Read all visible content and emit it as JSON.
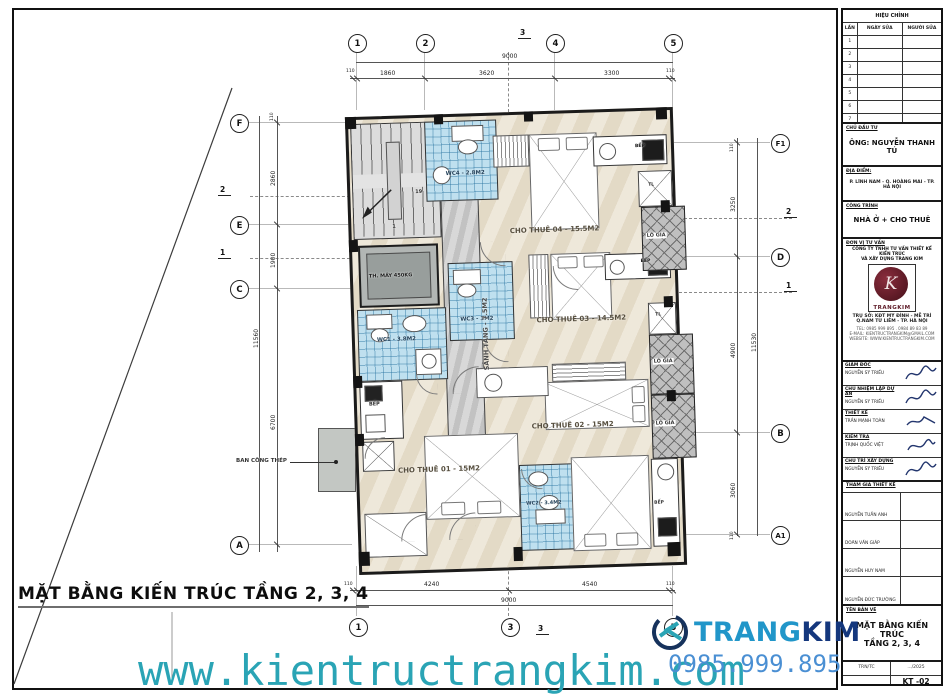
{
  "sheet_title": "MẶT BẰNG KIẾN TRÚC TẦNG 2, 3, 4",
  "footer": {
    "website": "www.kientructrangkim.com",
    "phone": "0985.999.895",
    "logo_trang": "TRANG",
    "logo_kim": "KIM"
  },
  "plan": {
    "rooms": {
      "cho_thue_01": "CHO THUÊ 01 - 15M2",
      "cho_thue_02": "CHO THUÊ 02 - 15M2",
      "cho_thue_03": "CHO THUÊ 03 - 14.5M2",
      "cho_thue_04": "CHO THUÊ 04 - 15.5M2",
      "wc1": "WC1 - 3.8M2",
      "wc2": "WC2 - 3.4M2",
      "wc3": "WC3 - 3M2",
      "wc4": "WC4 - 2.8M2",
      "sanh_tang": "SẢNH TẦNG - 7.5M2",
      "thang_may": "TH. MÁY 450KG",
      "bep": "BẾP",
      "lo_gia": "LÔ GIA",
      "tl": "TL",
      "ban_cong": "BAN CÔNG THÉP",
      "stair_num_top": "19",
      "stair_num_bottom": "1"
    }
  },
  "grid": {
    "top": [
      "1",
      "2",
      "4",
      "5"
    ],
    "bottom": [
      "1",
      "3",
      "5"
    ],
    "left": [
      "F",
      "E",
      "C",
      "A"
    ],
    "right": [
      "F1",
      "D",
      "B",
      "A1"
    ],
    "section_v": "3",
    "section_upper": "2",
    "section_lower": "1"
  },
  "dims": {
    "top_total": "9000",
    "top": [
      "110",
      "1860",
      "3620",
      "3300",
      "110"
    ],
    "bottom_total": "9000",
    "bottom": [
      "110",
      "4240",
      "4540",
      "110"
    ],
    "left_total": "11560",
    "left": [
      "110",
      "2860",
      "1900",
      "6700"
    ],
    "right_total": "11530",
    "right": [
      "110",
      "3250",
      "4900",
      "3060",
      "110"
    ]
  },
  "titleblock": {
    "revision": {
      "title": "HIỆU CHỈNH",
      "cols": [
        "LẦN",
        "NGÀY SỬA",
        "NGƯỜI SỬA"
      ],
      "rows": [
        "1",
        "2",
        "3",
        "4",
        "5",
        "6",
        "7"
      ]
    },
    "investor": {
      "label": "CHỦ ĐẦU TƯ",
      "value": "ÔNG: NGUYỄN THANH TÚ"
    },
    "location": {
      "label": "ĐỊA ĐIỂM:",
      "value": "P. LĨNH NAM - Q. HOÀNG MAI - TP. HÀ NỘI"
    },
    "project": {
      "label": "CÔNG TRÌNH",
      "value": "NHÀ Ở + CHO THUÊ"
    },
    "consultant": {
      "label": "ĐƠN VỊ TƯ VẤN",
      "company1": "CÔNG TY TNHH TƯ VẤN THIẾT KẾ KIẾN TRÚC",
      "company2": "VÀ XÂY DỰNG TRANG KIM",
      "logo_text": "TRANGKIM",
      "logo_k": "K",
      "address1": "TRỤ SỞ: KĐT MỸ ĐÌNH - MỄ TRÌ",
      "address2": "Q.NAM TỪ LIÊM - TP. HÀ NỘI",
      "tel": "TEL: 0985 999 895 . 0984 89 83 89",
      "email": "E-MAIL: KIENTRUCTRANGKIM@GMAIL.COM",
      "website": "WEBSITE: WWW.KIENTRUCTRANGKIM.COM"
    },
    "signatures": [
      {
        "role": "GIÁM ĐỐC",
        "name": "NGUYỄN SỸ TRIỀU"
      },
      {
        "role": "CHỦ NHIỆM LẬP DỰ ÁN",
        "name": "NGUYỄN SỸ TRIỀU"
      },
      {
        "role": "THIẾT KẾ",
        "name": "TRẦN MẠNH TOÀN"
      },
      {
        "role": "KIỂM TRA",
        "name": "TRỊNH QUỐC VIỆT"
      },
      {
        "role": "CHỦ TRÌ XÂY DỰNG",
        "name": "NGUYỄN SỸ TRIỀU"
      }
    ],
    "participants": {
      "label": "THAM GIA THIẾT KẾ",
      "names": [
        "NGUYỄN TUẤN ANH",
        "DOÃN VĂN GIÁP",
        "NGUYỄN HUY NAM",
        "NGUYỄN ĐỨC TRƯỜNG"
      ]
    },
    "drawing": {
      "label": "TÊN BẢN VẼ",
      "title1": "MẶT BẰNG KIẾN TRÚC",
      "title2": "TẦNG 2, 3, 4"
    },
    "meta": {
      "scale_label": "TRN/TC",
      "date": ".../2025",
      "number": "KT -02"
    }
  },
  "colors": {
    "wc_tile": "#bfe0ef",
    "floor": "#e9e0cd",
    "accent_teal": "#2aa4b5",
    "accent_blue": "#4a8fd3",
    "logo_maroon": "#5d1a26"
  }
}
